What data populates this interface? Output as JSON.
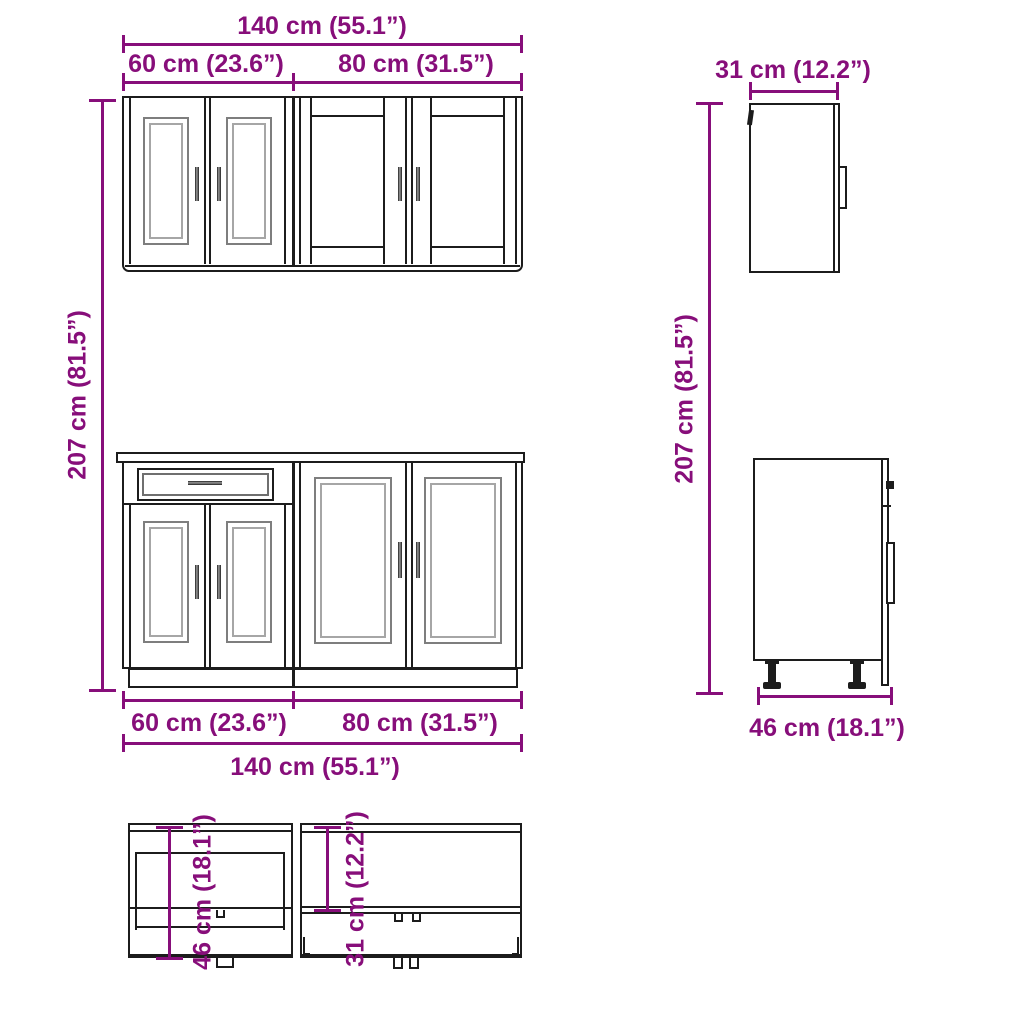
{
  "colors": {
    "accent": "#870E7A",
    "line": "#1C1C1C",
    "panel_gray": "#7E7E7E",
    "background": "#FFFFFF"
  },
  "drawing": {
    "subject": "kitchen-cabinet-set-technical-dimension-drawing",
    "units": [
      "cm",
      "inch"
    ]
  },
  "dimensions": {
    "top_width_total": "140 cm (55.1”)",
    "top_width_left": "60 cm (23.6”)",
    "top_width_right": "80 cm (31.5”)",
    "height_left": "207 cm (81.5”)",
    "height_right": "207 cm (81.5”)",
    "wall_side_depth": "31 cm (12.2”)",
    "base_side_depth": "46 cm (18.1”)",
    "bottom_width_left": "60 cm (23.6”)",
    "bottom_width_right": "80 cm (31.5”)",
    "bottom_width_total": "140 cm (55.1”)",
    "plan_base_depth": "46 cm (18.1”)",
    "plan_wall_depth": "31 cm (12.2”)"
  }
}
